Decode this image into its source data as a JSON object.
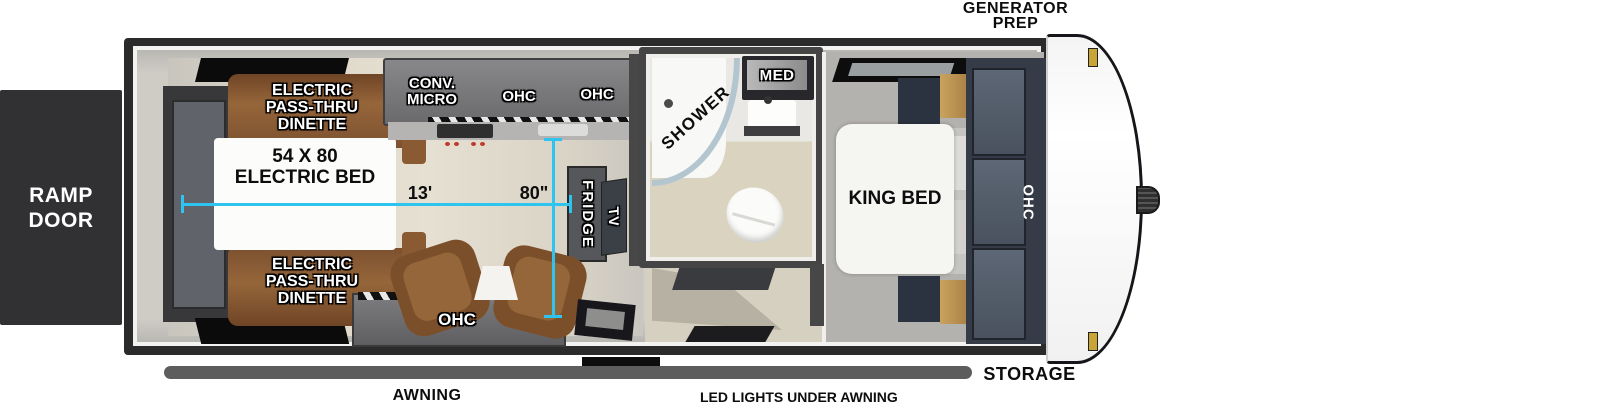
{
  "plan": {
    "ramp_door": [
      "RAMP",
      "DOOR"
    ],
    "generator_prep": [
      "GENERATOR",
      "PREP"
    ],
    "storage": "STORAGE",
    "awning": "AWNING",
    "led_lights": "LED LIGHTS UNDER AWNING",
    "garage": {
      "dinette_top": [
        "ELECTRIC",
        "PASS-THRU",
        "DINETTE"
      ],
      "dinette_bottom": [
        "ELECTRIC",
        "PASS-THRU",
        "DINETTE"
      ],
      "bed": [
        "54 X 80",
        "ELECTRIC BED"
      ],
      "length_dim": "13'",
      "width_dim": "80\"",
      "ohc": "OHC"
    },
    "kitchen": {
      "conv_micro": [
        "CONV.",
        "MICRO"
      ],
      "ohc_1": "OHC",
      "ohc_2": "OHC",
      "fridge": "FRIDGE",
      "tv": "TV"
    },
    "bath": {
      "shower": "SHOWER",
      "med": "MED"
    },
    "bedroom": {
      "king_bed": "KING BED",
      "ohc": "OHC"
    }
  },
  "colors": {
    "dimension_cyan": "#2fc4f0",
    "dinette_brown": "#8a5a33",
    "cabinet_gray": "#6d6d6f",
    "wardrobe_slate": "#39404c",
    "wood_tan": "#b08748",
    "trailer_frame": "#2b2b2b",
    "ramp_door_dark": "#313134"
  }
}
